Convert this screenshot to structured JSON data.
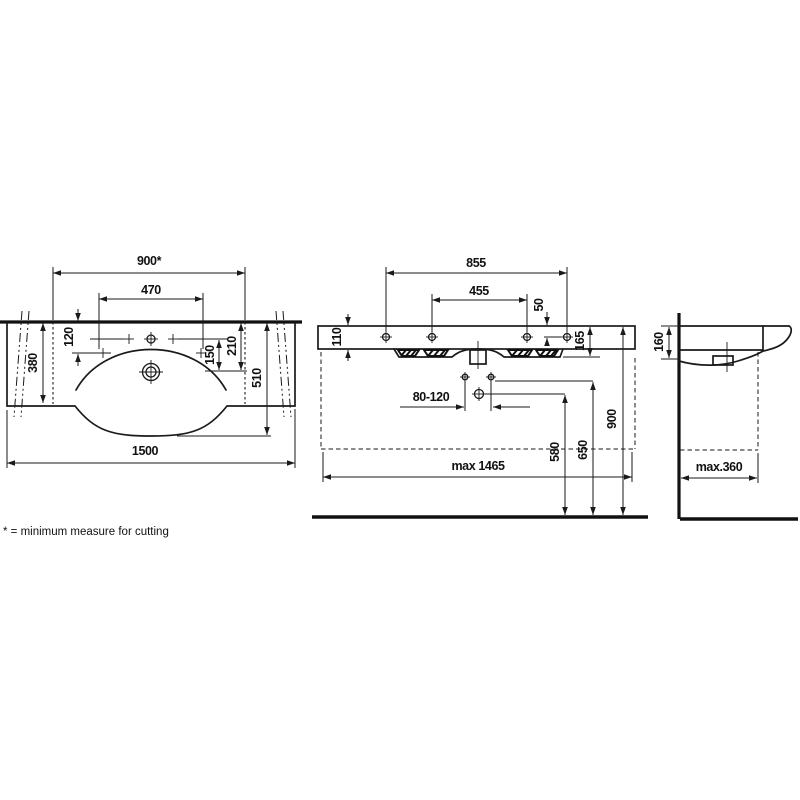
{
  "footnote": "* = minimum measure for cutting",
  "plan": {
    "d900": "900*",
    "d470": "470",
    "d120": "120",
    "d380": "380",
    "d150": "150",
    "d210": "210",
    "d510": "510",
    "d1500": "1500"
  },
  "front": {
    "d855": "855",
    "d455": "455",
    "d50": "50",
    "d110": "110",
    "d165": "165",
    "d900": "900",
    "d80120": "80-120",
    "d580": "580",
    "d650": "650",
    "d1465": "max 1465"
  },
  "side": {
    "d160": "160",
    "d360": "max.360"
  },
  "colors": {
    "line": "#1a1a1a",
    "background": "#ffffff"
  }
}
